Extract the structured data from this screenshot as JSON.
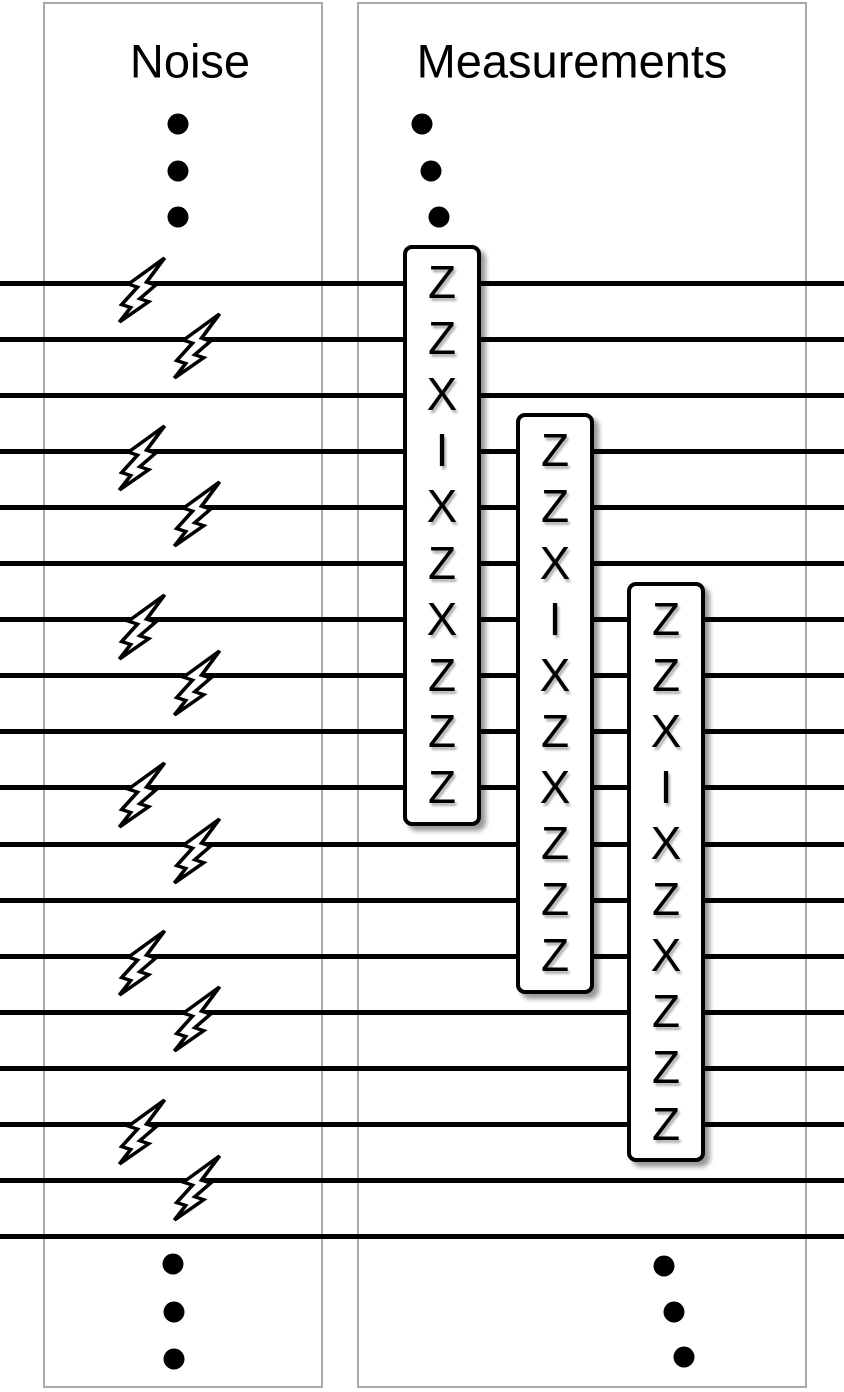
{
  "figure": {
    "kind": "quantum-error-correction-circuit-diagram",
    "background": "#ffffff"
  },
  "panels": {
    "noise": {
      "title": "Noise"
    },
    "measurements": {
      "title": "Measurements"
    }
  },
  "circuit": {
    "wire_count": 18,
    "noise_bolt_pairs": [
      [
        0,
        1
      ],
      [
        3,
        4
      ],
      [
        6,
        7
      ],
      [
        9,
        10
      ],
      [
        12,
        13
      ],
      [
        15,
        16
      ]
    ],
    "measurement_boxes": [
      {
        "start_wire": 0,
        "letters": [
          "Z",
          "Z",
          "X",
          "I",
          "X",
          "Z",
          "X",
          "Z",
          "Z",
          "Z"
        ]
      },
      {
        "start_wire": 3,
        "letters": [
          "Z",
          "Z",
          "X",
          "I",
          "X",
          "Z",
          "X",
          "Z",
          "Z",
          "Z"
        ]
      },
      {
        "start_wire": 6,
        "letters": [
          "Z",
          "Z",
          "X",
          "I",
          "X",
          "Z",
          "X",
          "Z",
          "Z",
          "Z"
        ]
      }
    ],
    "ellipsis_groups": [
      {
        "name": "noise-top",
        "count": 3
      },
      {
        "name": "measurements-top",
        "count": 3
      },
      {
        "name": "noise-bottom",
        "count": 3
      },
      {
        "name": "measurements-bottom",
        "count": 3
      }
    ]
  },
  "icons": {
    "noise": "lightning-bolt-icon"
  },
  "colors": {
    "wire": "#000000",
    "panel_border": "#a9a9a9",
    "box_border": "#000000",
    "box_fill": "#ffffff",
    "text": "#000000"
  }
}
